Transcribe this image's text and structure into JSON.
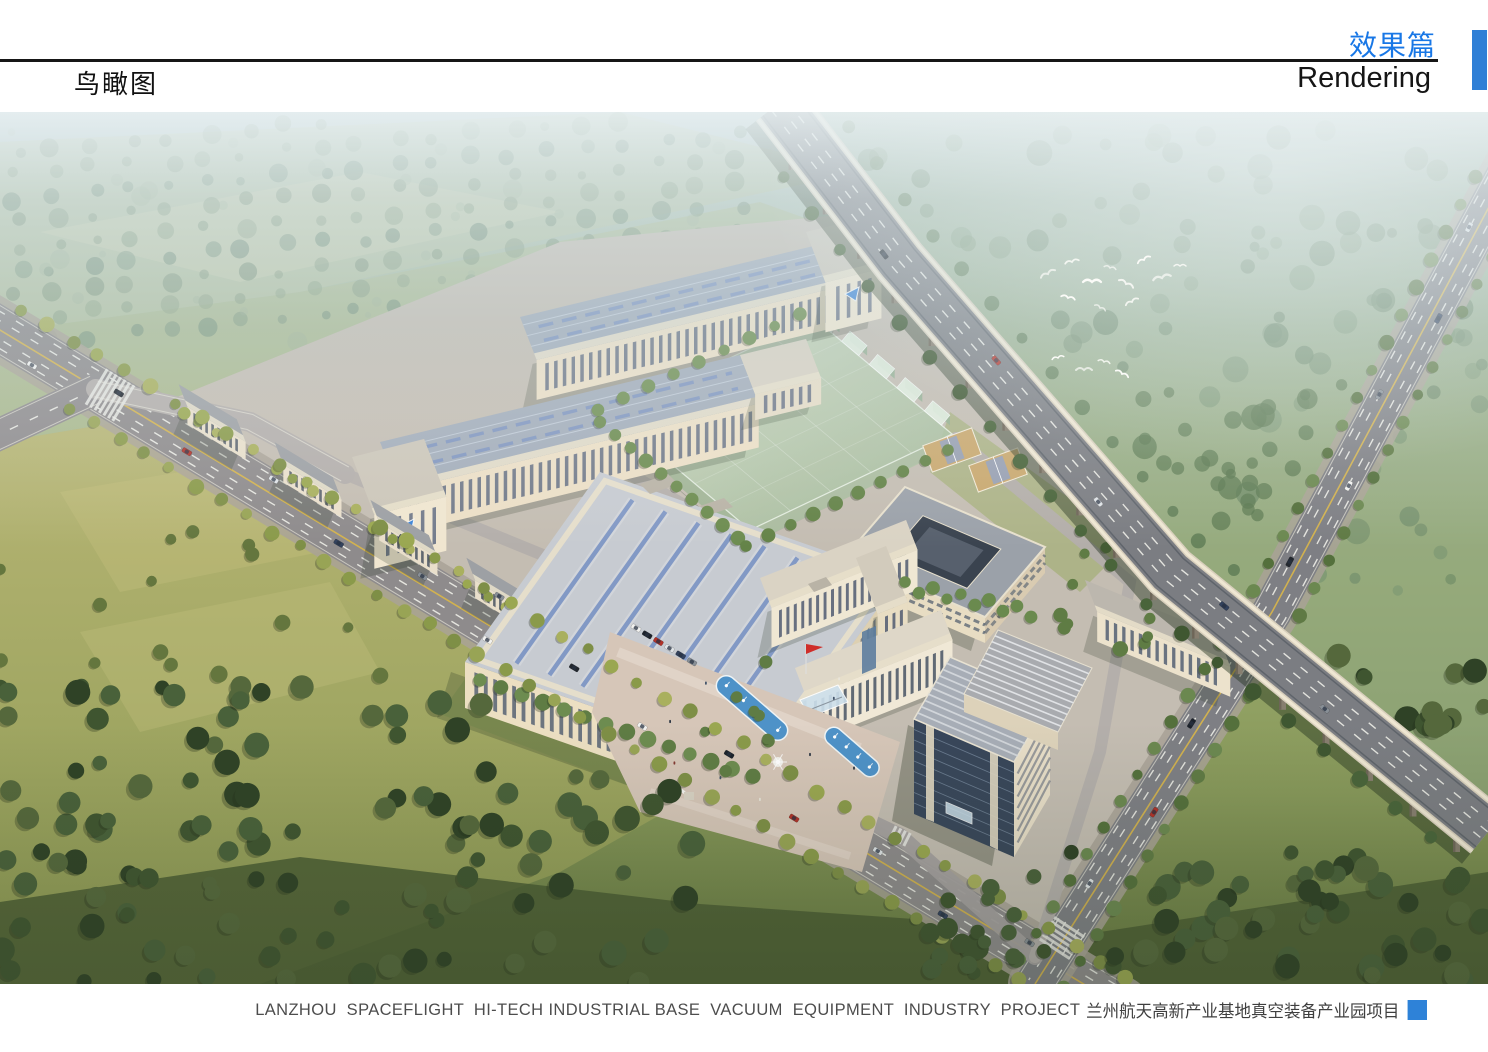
{
  "header": {
    "page_title": "鸟瞰图",
    "section_title_cn": "效果篇",
    "section_title_en": "Rendering"
  },
  "footer": {
    "caption_en": "LANZHOU  SPACEFLIGHT  HI-TECH INDUSTRIAL BASE  VACUUM  EQUIPMENT  INDUSTRY  PROJECT",
    "caption_cn": "兰州航天高新产业基地真空装备产业园项目"
  },
  "colors": {
    "title_blue": "#1877e6",
    "tab_blue": "#2f7fd6",
    "square_blue": "#2e82d8"
  }
}
